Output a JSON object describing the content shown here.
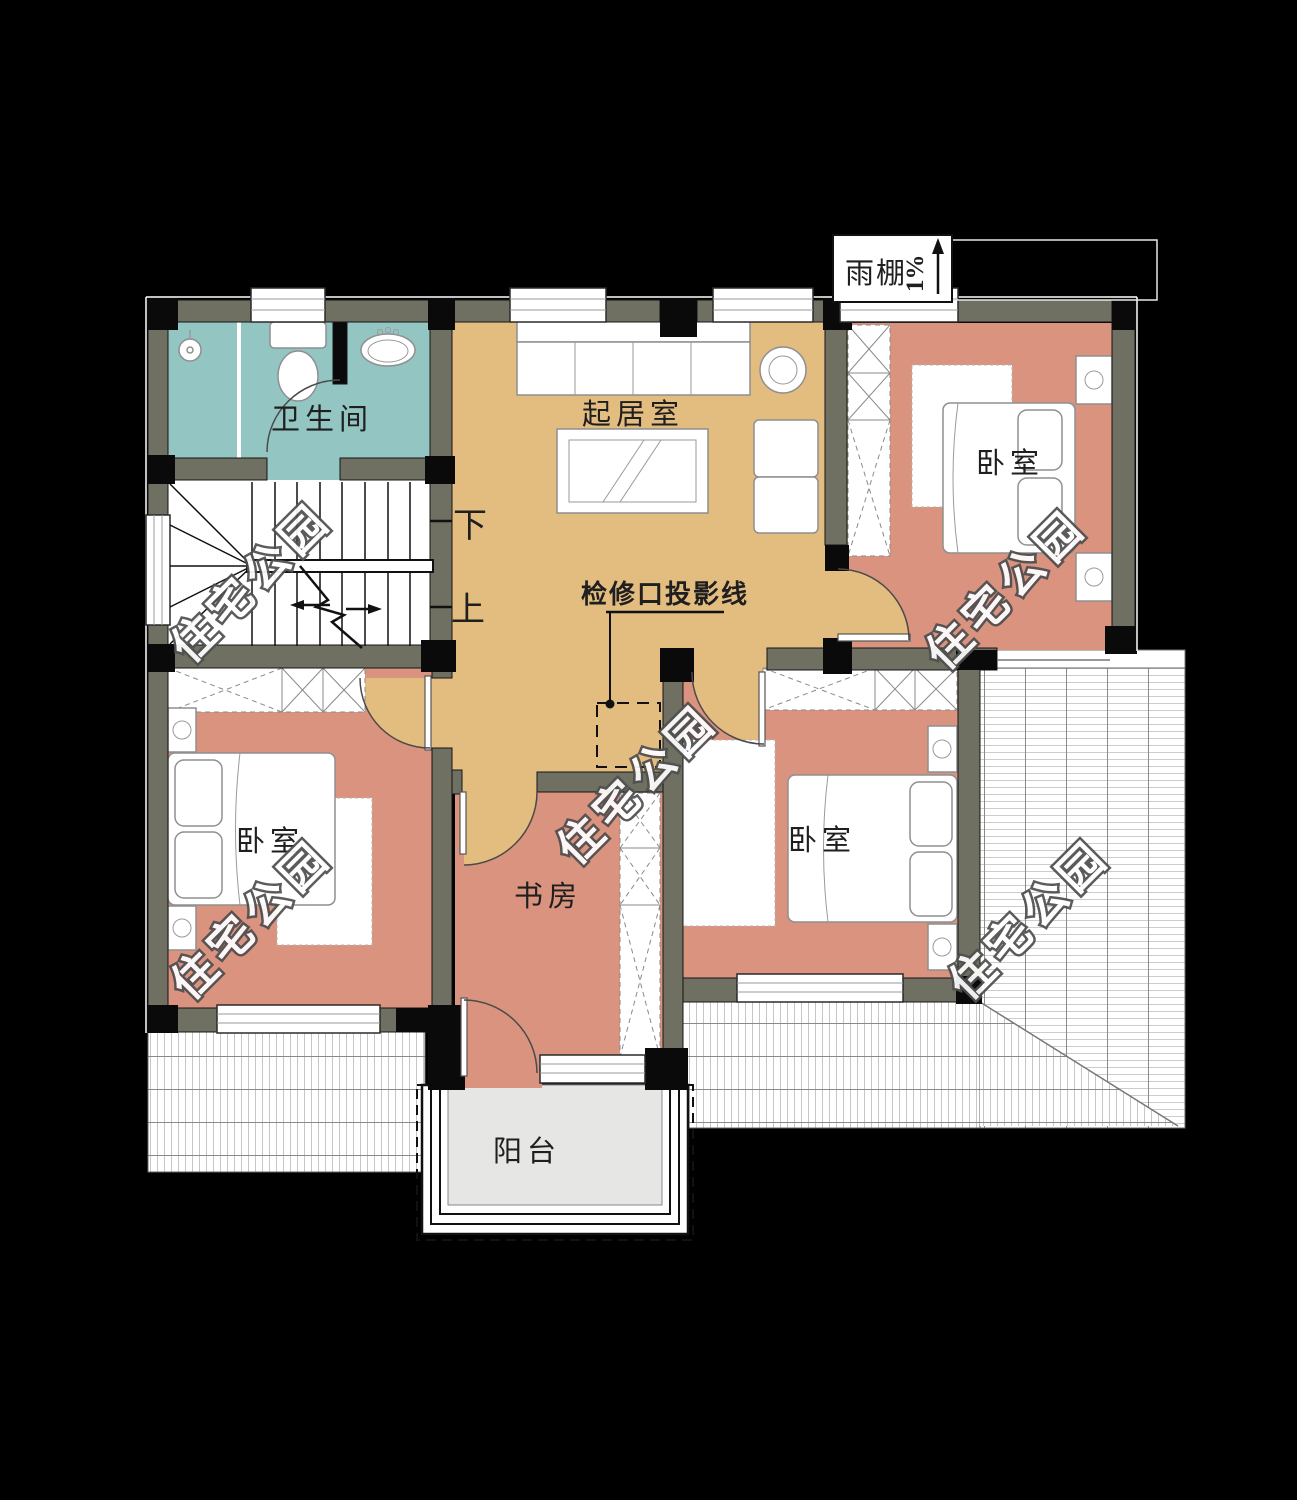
{
  "plan": {
    "watermark": "住宅公园",
    "rooms": {
      "bathroom": "卫生间",
      "living": "起居室",
      "bedroom": "卧室",
      "study": "书房",
      "balcony": "阳台"
    },
    "stairs": {
      "down": "下",
      "up": "上"
    },
    "canopy": {
      "label": "雨棚",
      "slope": "1%"
    },
    "access_hatch_label": "检修口投影线",
    "colors": {
      "background": "#000000",
      "wall": "#6F6F62",
      "column": "#0A0A0A",
      "bathroom_floor": "#93C5C2",
      "living_floor": "#E3BC80",
      "bedroom_floor": "#D9937F",
      "balcony_floor": "#E6E6E4",
      "label_text": "#1F1F1F"
    }
  }
}
